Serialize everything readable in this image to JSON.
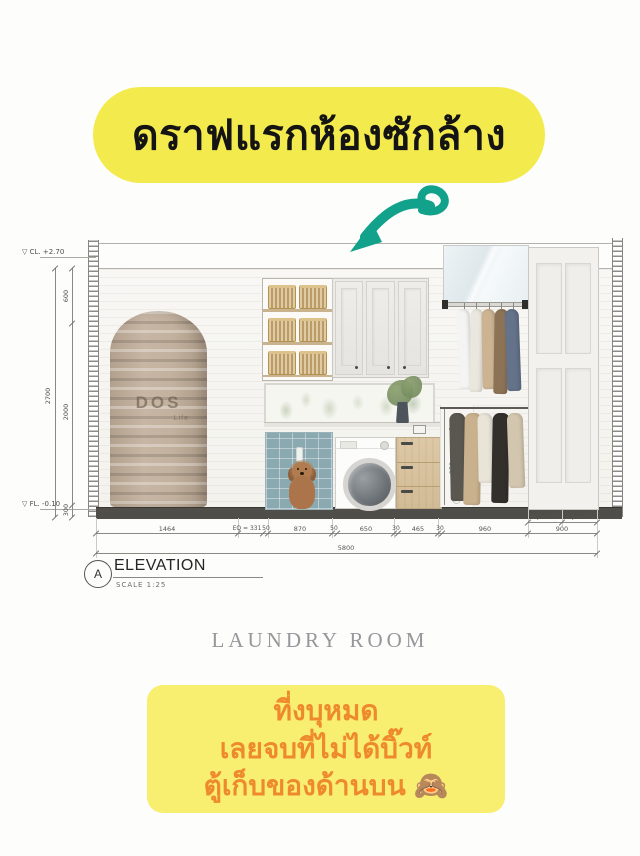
{
  "colors": {
    "banner_yellow": "#f3eb4d",
    "bottom_banner_yellow": "#f8ee70",
    "banner_text_orange": "#ee8a2c",
    "arrow_teal": "#12a18a"
  },
  "top_banner": {
    "text": "ดราฟแรกห้องซักล้าง"
  },
  "elevation": {
    "levels": {
      "ceiling": "▽ CL. +2.70",
      "floor": "▽ FL. -0.10"
    },
    "tank": {
      "brand": "DOS",
      "sub": "Life"
    },
    "dims": {
      "left_overall": "2700",
      "left_top": "600",
      "left_mid": "2000",
      "left_bottom": "300",
      "rod_height": "950",
      "eq_door": [
        "EQ = 450",
        "EQ = 450"
      ],
      "bottom": [
        "1464",
        "EQ = 331",
        "50",
        "870",
        "50",
        "650",
        "30",
        "465",
        "30",
        "960",
        "900"
      ],
      "total": "5800"
    },
    "title": {
      "bubble": "A",
      "label": "ELEVATION",
      "scale": "SCALE  1:25"
    }
  },
  "caption": "LAUNDRY ROOM",
  "bottom_banner": {
    "line1": "ที่งบุหมด",
    "line2": "เลยจบที่ไม่ได้บิ๊วท์",
    "line3": "ตู้เก็บของด้านบน 🙈"
  }
}
